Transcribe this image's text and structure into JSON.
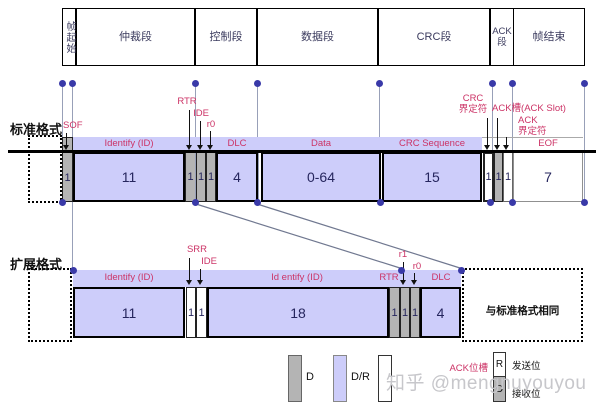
{
  "colors": {
    "field_fill": "#cdcdfa",
    "bit_fill": "#b4b4b4",
    "label_red": "#cc3366",
    "dot_blue": "#3939a8"
  },
  "top_segments": [
    "帧起始",
    "仲裁段",
    "控制段",
    "数据段",
    "CRC段",
    "ACK段",
    "帧结束"
  ],
  "standard": {
    "section_label": "标准格式",
    "sof_label": "SOF",
    "header": {
      "id": "Identify  (ID)",
      "dlc": "DLC",
      "data": "Data",
      "crc": "CRC Sequence",
      "eof": "EOF"
    },
    "bit_labels": {
      "rtr": "RTR",
      "ide": "IDE",
      "r0": "r0",
      "crc_delim_1": "CRC",
      "crc_delim_2": "界定符",
      "ack_slot": "ACK槽(ACK Slot)",
      "ack_delim_1": "ACK",
      "ack_delim_2": "界定符"
    },
    "values": {
      "sof": "1",
      "id": "11",
      "rtr": "1",
      "ide": "1",
      "r0": "1",
      "dlc": "4",
      "data": "0-64",
      "crc": "15",
      "crc_delim": "1",
      "ack_slot": "1",
      "ack_delim": "1",
      "eof": "7"
    }
  },
  "extended": {
    "section_label": "扩展格式",
    "header": {
      "id": "Identify  (ID)",
      "id2": "Id entify (ID)",
      "rtr": "RTR",
      "dlc": "DLC"
    },
    "bit_labels": {
      "srr": "SRR",
      "ide": "IDE",
      "r1": "r1",
      "r0": "r0"
    },
    "values": {
      "id": "11",
      "srr": "1",
      "ide": "1",
      "id2": "18",
      "rtr": "1",
      "r1": "1",
      "r0": "1",
      "dlc": "4"
    },
    "same_note": "与标准格式相同"
  },
  "legend": {
    "d": "D",
    "dr": "D/R",
    "ack_slot": "ACK位槽",
    "send_bit": "R",
    "recv_bit": "D",
    "send_label": "发送位",
    "recv_label": "接收位"
  },
  "watermark": "知乎 @mengnuyouyou"
}
